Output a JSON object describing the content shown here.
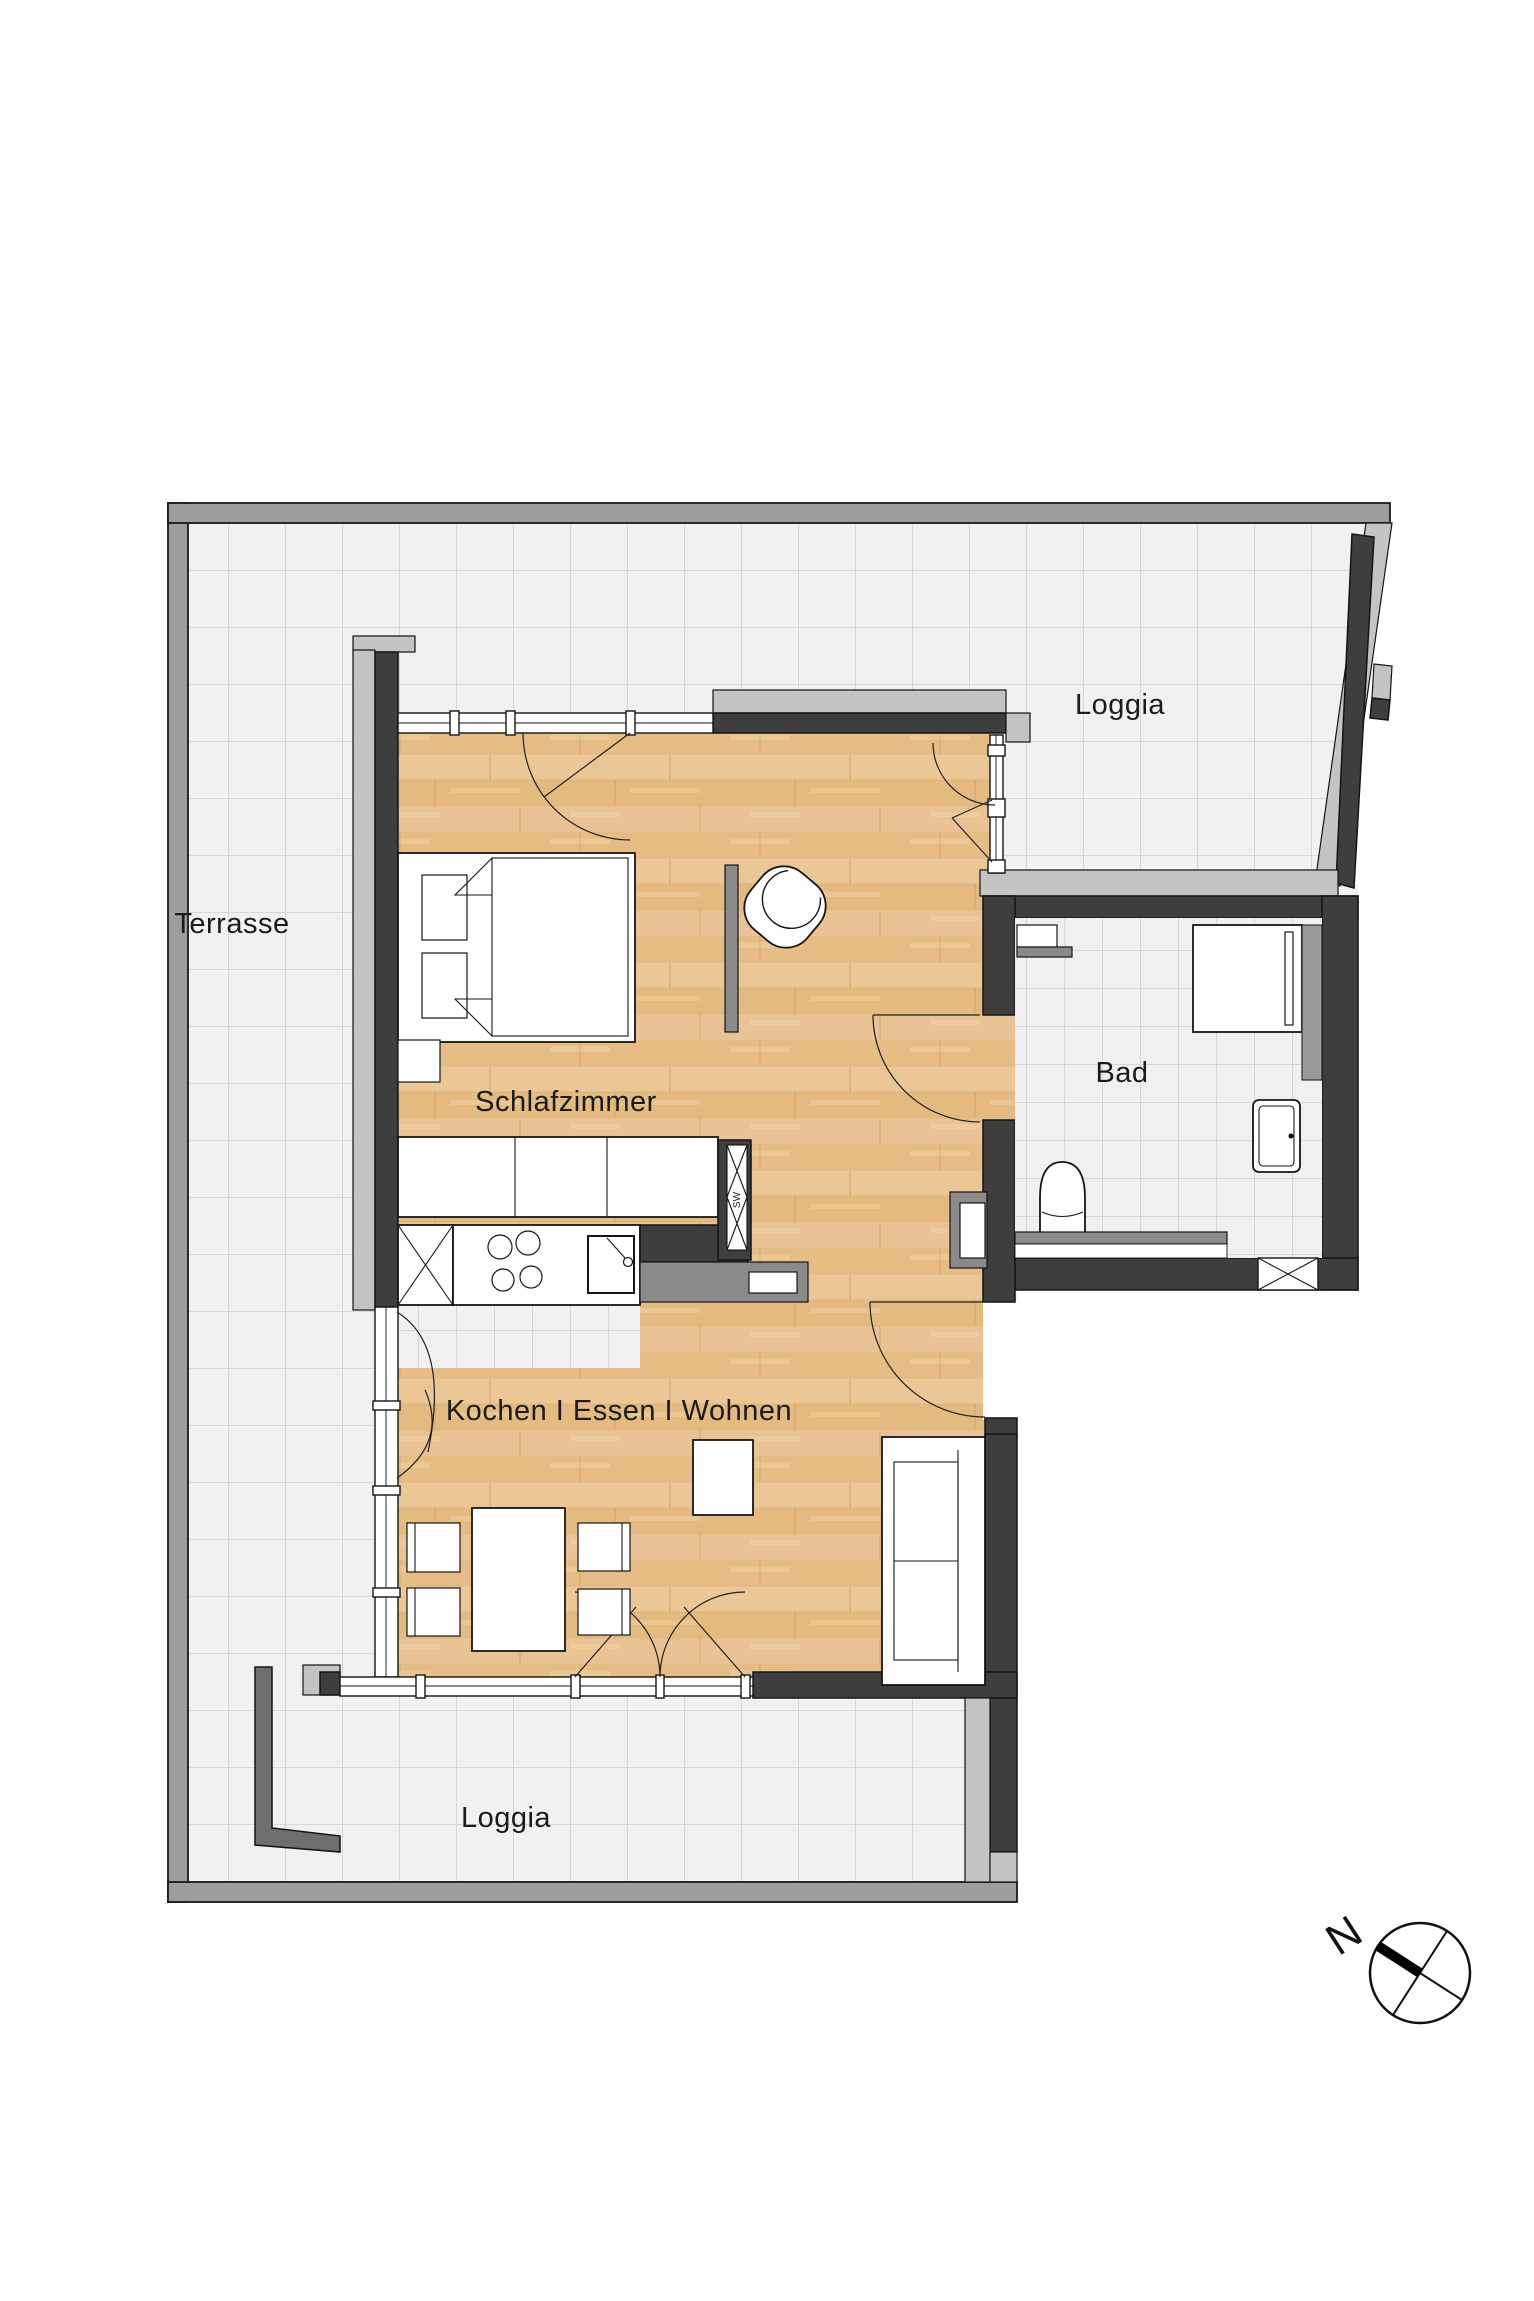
{
  "plan": {
    "type": "apartment-floor-plan",
    "rooms": {
      "terrasse": {
        "label": "Terrasse"
      },
      "loggia_top": {
        "label": "Loggia"
      },
      "bad": {
        "label": "Bad"
      },
      "schlafzimmer": {
        "label": "Schlafzimmer"
      },
      "wohnbereich": {
        "label": "Kochen I Essen I Wohnen"
      },
      "loggia_bottom": {
        "label": "Loggia"
      }
    },
    "shaft": {
      "label": "SW"
    },
    "compass": {
      "north_letter": "N"
    },
    "colors": {
      "wood_floor": "#e8c28c",
      "outdoor_tile": "#f1f1f1",
      "outdoor_tile_line": "#c9c9c9",
      "indoor_tile": "#f0f0f0",
      "indoor_tile_line": "#bdbdbd",
      "wall_dark": "#3e3e3e",
      "wall_light": "#c4c4c4",
      "wall_medium": "#8a8a8a",
      "outer_band": "#9d9d9d",
      "text": "#1b1b1b"
    }
  }
}
